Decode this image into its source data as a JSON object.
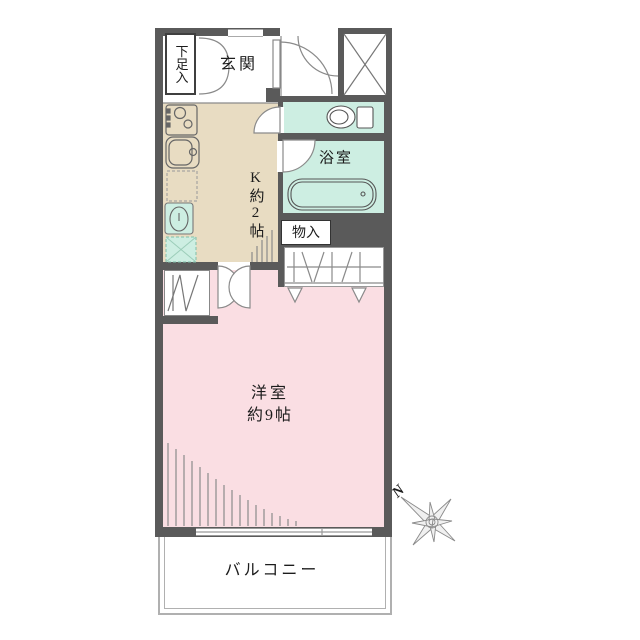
{
  "floorplan": {
    "labels": {
      "shoe_closet": "下足入",
      "entrance": "玄関",
      "kitchen": "K約2帖",
      "bathroom": "浴室",
      "storage": "物入",
      "main_room": "洋室",
      "main_room_size": "約9帖",
      "balcony": "バルコニー",
      "north": "N"
    },
    "colors": {
      "wall": "#5a5a5a",
      "kitchen_floor": "#e8dcc2",
      "wet_area": "#cdeee2",
      "main_room_floor": "#fadee3"
    }
  }
}
